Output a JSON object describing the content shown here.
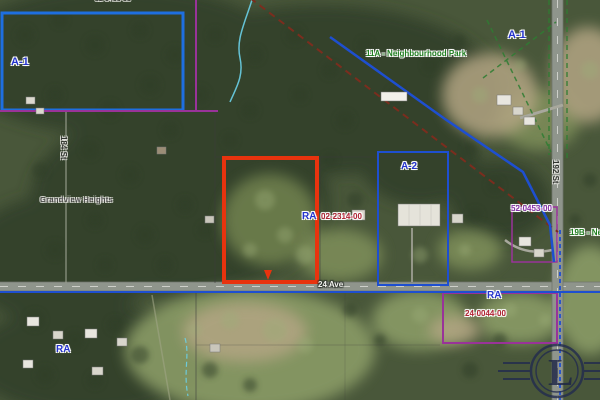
{
  "zones": {
    "a1_left": "A-1",
    "a1_right": "A-1",
    "a2": "A-2",
    "ra_center": "RA",
    "ra_right": "RA",
    "ra_bottom_left": "RA"
  },
  "parks": {
    "park_11a": "11A - Neighbourhood Park",
    "park_19b": "19B - Neighbourhood"
  },
  "parcel_ids": {
    "top_clipped": "02-0450-00",
    "center": "02-2314-00",
    "right": "52-0453-00",
    "bottom_right": "24-0044-00"
  },
  "places": {
    "area_name": "Grandview Heights"
  },
  "roads": {
    "ave_24": "24 Ave",
    "st_192": "192 St",
    "st_184": "184 St"
  },
  "watermark": {
    "icon": "legal-seal-logo",
    "letter": "L"
  },
  "colors": {
    "selected_parcel_red": "#e8330e",
    "zone_boundary_blue": "#1e4fd0",
    "a1_box_blue": "#1e6fe0",
    "cadastral_purple": "#993399",
    "dashed_boundary_brown": "#7b2d1e",
    "park_dash_green": "#2e7d32",
    "zone_label_blue": "#2433cc",
    "park_label_green": "#1e7d1e",
    "parcel_id_red": "#b02233",
    "parcel_id_purple": "#8833aa",
    "stream_cyan": "#6ad0e8",
    "road_gray": "#8f958c"
  }
}
